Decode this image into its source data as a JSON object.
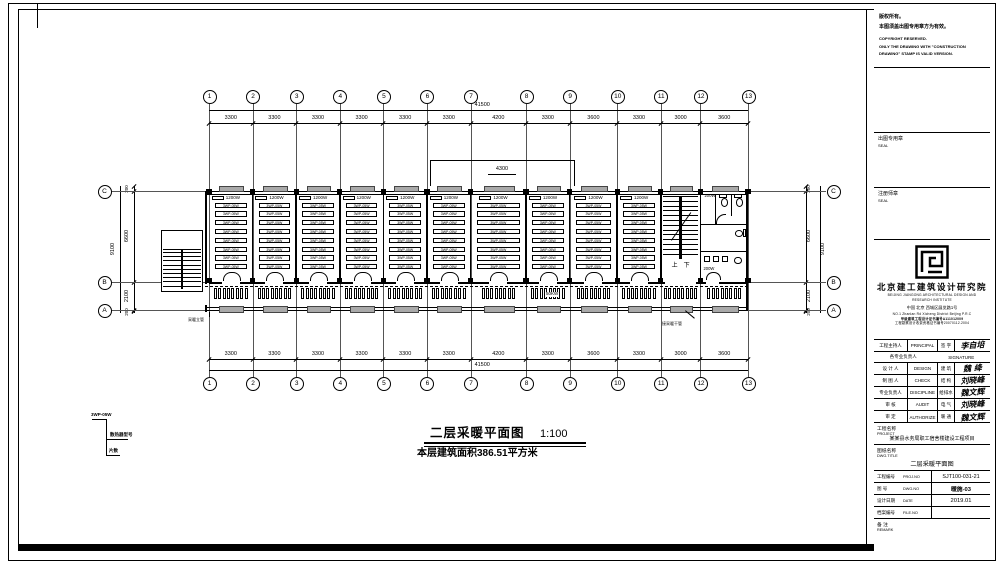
{
  "plan": {
    "title": "二层采暖平面图",
    "scale": "1:100",
    "area_note": "本层建筑面积386.51平方米",
    "grid_cols": [
      "1",
      "2",
      "3",
      "4",
      "5",
      "6",
      "7",
      "8",
      "9",
      "10",
      "11",
      "12",
      "13"
    ],
    "col_dims": [
      3300,
      3300,
      3300,
      3300,
      3300,
      3300,
      4200,
      3300,
      3600,
      3300,
      3000,
      3600
    ],
    "total_dim": "41500",
    "row_labels": [
      "C",
      "B",
      "A"
    ],
    "v_dims": {
      "total": "9100",
      "cb": "6600",
      "ba": "2100",
      "edge": "200"
    },
    "canopy_dim": "4300",
    "room": {
      "radiator": "1200W",
      "bed": "3WP-05W",
      "count": 10,
      "beds": 8
    },
    "corridor": {
      "fins": 8,
      "note": "50KW"
    },
    "stair": {
      "up": "上",
      "down": "下"
    },
    "toilet": {
      "radiator": "200W"
    },
    "risers": {
      "left": "采暖立管",
      "right": "接采暖干管"
    },
    "legend": {
      "top": "3WP-05W",
      "mid": "散热器型号",
      "bottom": "片数"
    }
  },
  "tb": {
    "copyright": [
      "版权所有。",
      "本图须盖出图专用章方为有效。",
      "COPYRIGHT RESERVED.",
      "ONLY THE DRAWING WITH \"CONSTRUCTION",
      "DRAWING\" STAMP IS VALID VERSION."
    ],
    "seal1": {
      "cn": "出图专用章",
      "en": "SEAL"
    },
    "seal2": {
      "cn": "注册师章",
      "en": "SEAL"
    },
    "firm": {
      "cn": "北京建工建筑设计研究院",
      "en1": "BEIJING JIANGONG ARCHITECTURAL DESIGN AND",
      "en2": "RESEARCH INSTITUTE",
      "addr1": "中国 北京 西城区展览路1号",
      "addr2": "NO.1 Zhanlan Rd Xicheng District Beijing P.R.C",
      "cert1": "甲级建筑工程设计证书编号A111012009",
      "cert2": "工程勘察设计收费资格证书编号20070112.2004"
    },
    "sign": {
      "r0": {
        "cn": "工程主持人",
        "en": "PRINCIPAL",
        "mid": "签 字",
        "sig": "李自培"
      },
      "hdr": {
        "cn": "各专业负责人",
        "en": "SIGNATURE"
      },
      "r1": {
        "cn": "设 计 人",
        "en": "DESIGN",
        "mid": "建 筑",
        "sig": "魏 绛"
      },
      "r2": {
        "cn": "制 图 人",
        "en": "CHECK",
        "mid": "结 构",
        "sig": "刘晓峰"
      },
      "r3": {
        "cn": "专业负责人",
        "en": "DISCIPLINE",
        "mid": "给排水",
        "sig": "魏文辉"
      },
      "r4": {
        "cn": "审 核",
        "en": "AUDIT",
        "mid": "电 气",
        "sig": "刘晓峰"
      },
      "r5": {
        "cn": "审 定",
        "en": "AUTHORIZE",
        "mid": "暖 通",
        "sig": "魏文辉"
      }
    },
    "project": {
      "cn": "工程名称",
      "en": "PROJECT",
      "value": "某某县水务局职工宿舍楼建设工程项目"
    },
    "dwg": {
      "cn": "图纸名称",
      "en": "DWG.TITLE",
      "value": "二层采暖平面图"
    },
    "meta": [
      {
        "cn": "工程编号",
        "en": "PROJ.NO",
        "value": "SJT100-031-21"
      },
      {
        "cn": "图  号",
        "en": "DWG.NO",
        "value": "暖施-03"
      },
      {
        "cn": "设计日期",
        "en": "DATE",
        "value": "2019.01"
      },
      {
        "cn": "档案编号",
        "en": "FILE.NO",
        "value": ""
      }
    ],
    "remark": {
      "cn": "备  注",
      "en": "REMARK"
    }
  }
}
